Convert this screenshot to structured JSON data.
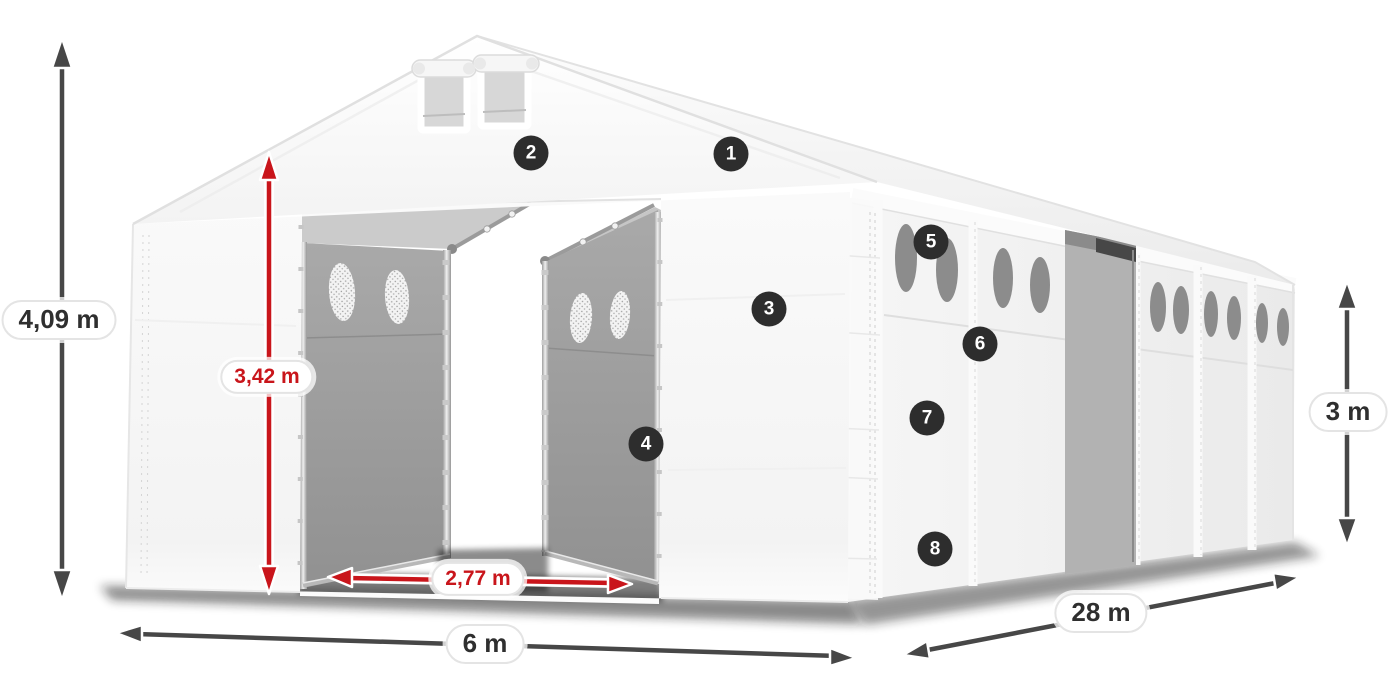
{
  "dimensions": {
    "total_height": {
      "value": "4,09 m",
      "style": "gray"
    },
    "entrance_height": {
      "value": "3,42 m",
      "style": "red"
    },
    "entrance_width": {
      "value": "2,77 m",
      "style": "red"
    },
    "front_width": {
      "value": "6 m",
      "style": "gray"
    },
    "length": {
      "value": "28 m",
      "style": "gray"
    },
    "side_height": {
      "value": "3 m",
      "style": "gray"
    }
  },
  "callouts": [
    {
      "number": "1"
    },
    {
      "number": "2"
    },
    {
      "number": "3"
    },
    {
      "number": "4"
    },
    {
      "number": "5"
    },
    {
      "number": "6"
    },
    {
      "number": "7"
    },
    {
      "number": "8"
    }
  ],
  "colors": {
    "dimension_red": "#c9151b",
    "dimension_gray": "#474747",
    "callout_background": "#2d2d2d",
    "callout_number": "#ffffff",
    "pill_border": "#e4e4e4"
  }
}
